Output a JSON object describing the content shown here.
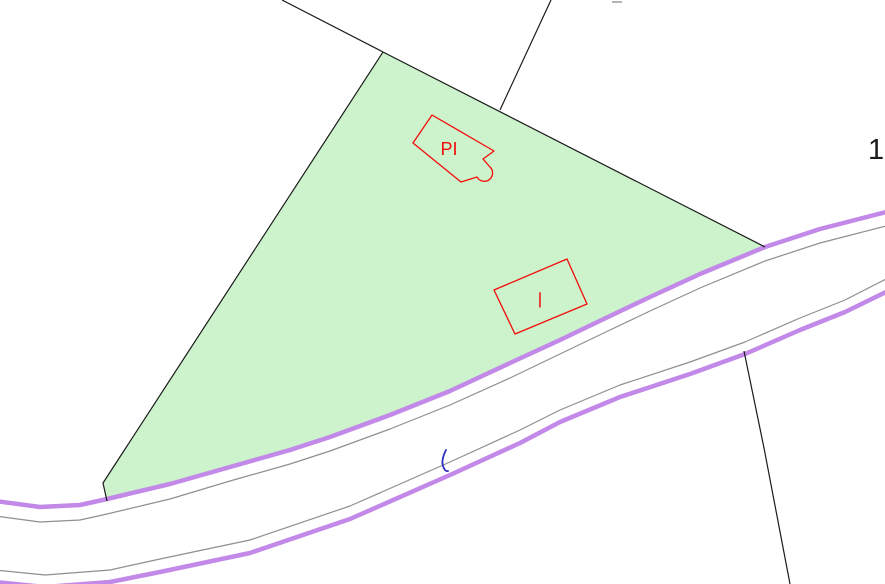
{
  "app": {
    "type": "cadastral-map-view",
    "description": "Parcel map with highlighted plot, buildings and road"
  },
  "map": {
    "width": 885,
    "height": 584,
    "labels": {
      "parcel_number": "1",
      "building1": "PI",
      "building2": "/"
    },
    "colors": {
      "background": "#ffffff",
      "parcel_fill": "#ccf3cb",
      "boundary_line": "#1a1a1a",
      "road_casing": "#c289e8",
      "road_inner": "#8f8f8f",
      "building_outline": "#f40b0b",
      "water_tick": "#2d2dc0",
      "faint_dash": "#b4b4b4",
      "parcel_number_color": "#1c1c1c"
    },
    "geometry": {
      "parcel": "M103,483 L383,52 L765,247 L700,274 L650,297 L610,316 L560,340 L510,363 L450,391 L390,415 L330,437 L290,450 L230,467 L170,484 L107,499 Z",
      "road": {
        "upper_casing": "M-5,501 L40,507 L80,505 L107,499 L170,484 L230,467 L290,450 L330,437 L390,415 L450,391 L510,363 L560,340 L610,316 L650,297 L700,274 L765,247 L820,229 L890,211",
        "upper_inner": "M-5,516 L40,522 L80,520 L107,514 L170,499 L230,481 L290,464 L330,451 L390,429 L450,405 L510,378 L560,354 L610,330 L650,311 L700,288 L765,261 L820,243 L890,225",
        "lower_inner": "M-5,570 L45,575 L110,570 L160,559 L250,540 L350,506 L450,462 L520,430 L560,410 L620,385 L690,362 L745,342 L800,318 L845,300 L890,277",
        "lower_casing": "M-5,582 L45,587 L110,582 L160,572 L250,553 L350,519 L450,475 L520,443 L560,422 L620,397 L690,374 L745,354 L800,330 L845,312 L890,290"
      },
      "boundaries": [
        "M282,0 L383,52",
        "M383,52 L103,483 L107,501",
        "M383,52 L765,247",
        "M551,0 L500,110",
        "M744,351 L764,448 L790,584"
      ],
      "buildings": [
        "M432,115 L494,151 L483,159 L490,167 A8.3,8.3 0 1 1 477,177 L461,182 L413,143 Z",
        "M567,259 L587,304 L515,334 L494,290 Z"
      ],
      "water_tick": "M446,450 Q441,460 443,466 Q445,472 448,471",
      "faint_dash": "M612,2 L622,2"
    }
  }
}
